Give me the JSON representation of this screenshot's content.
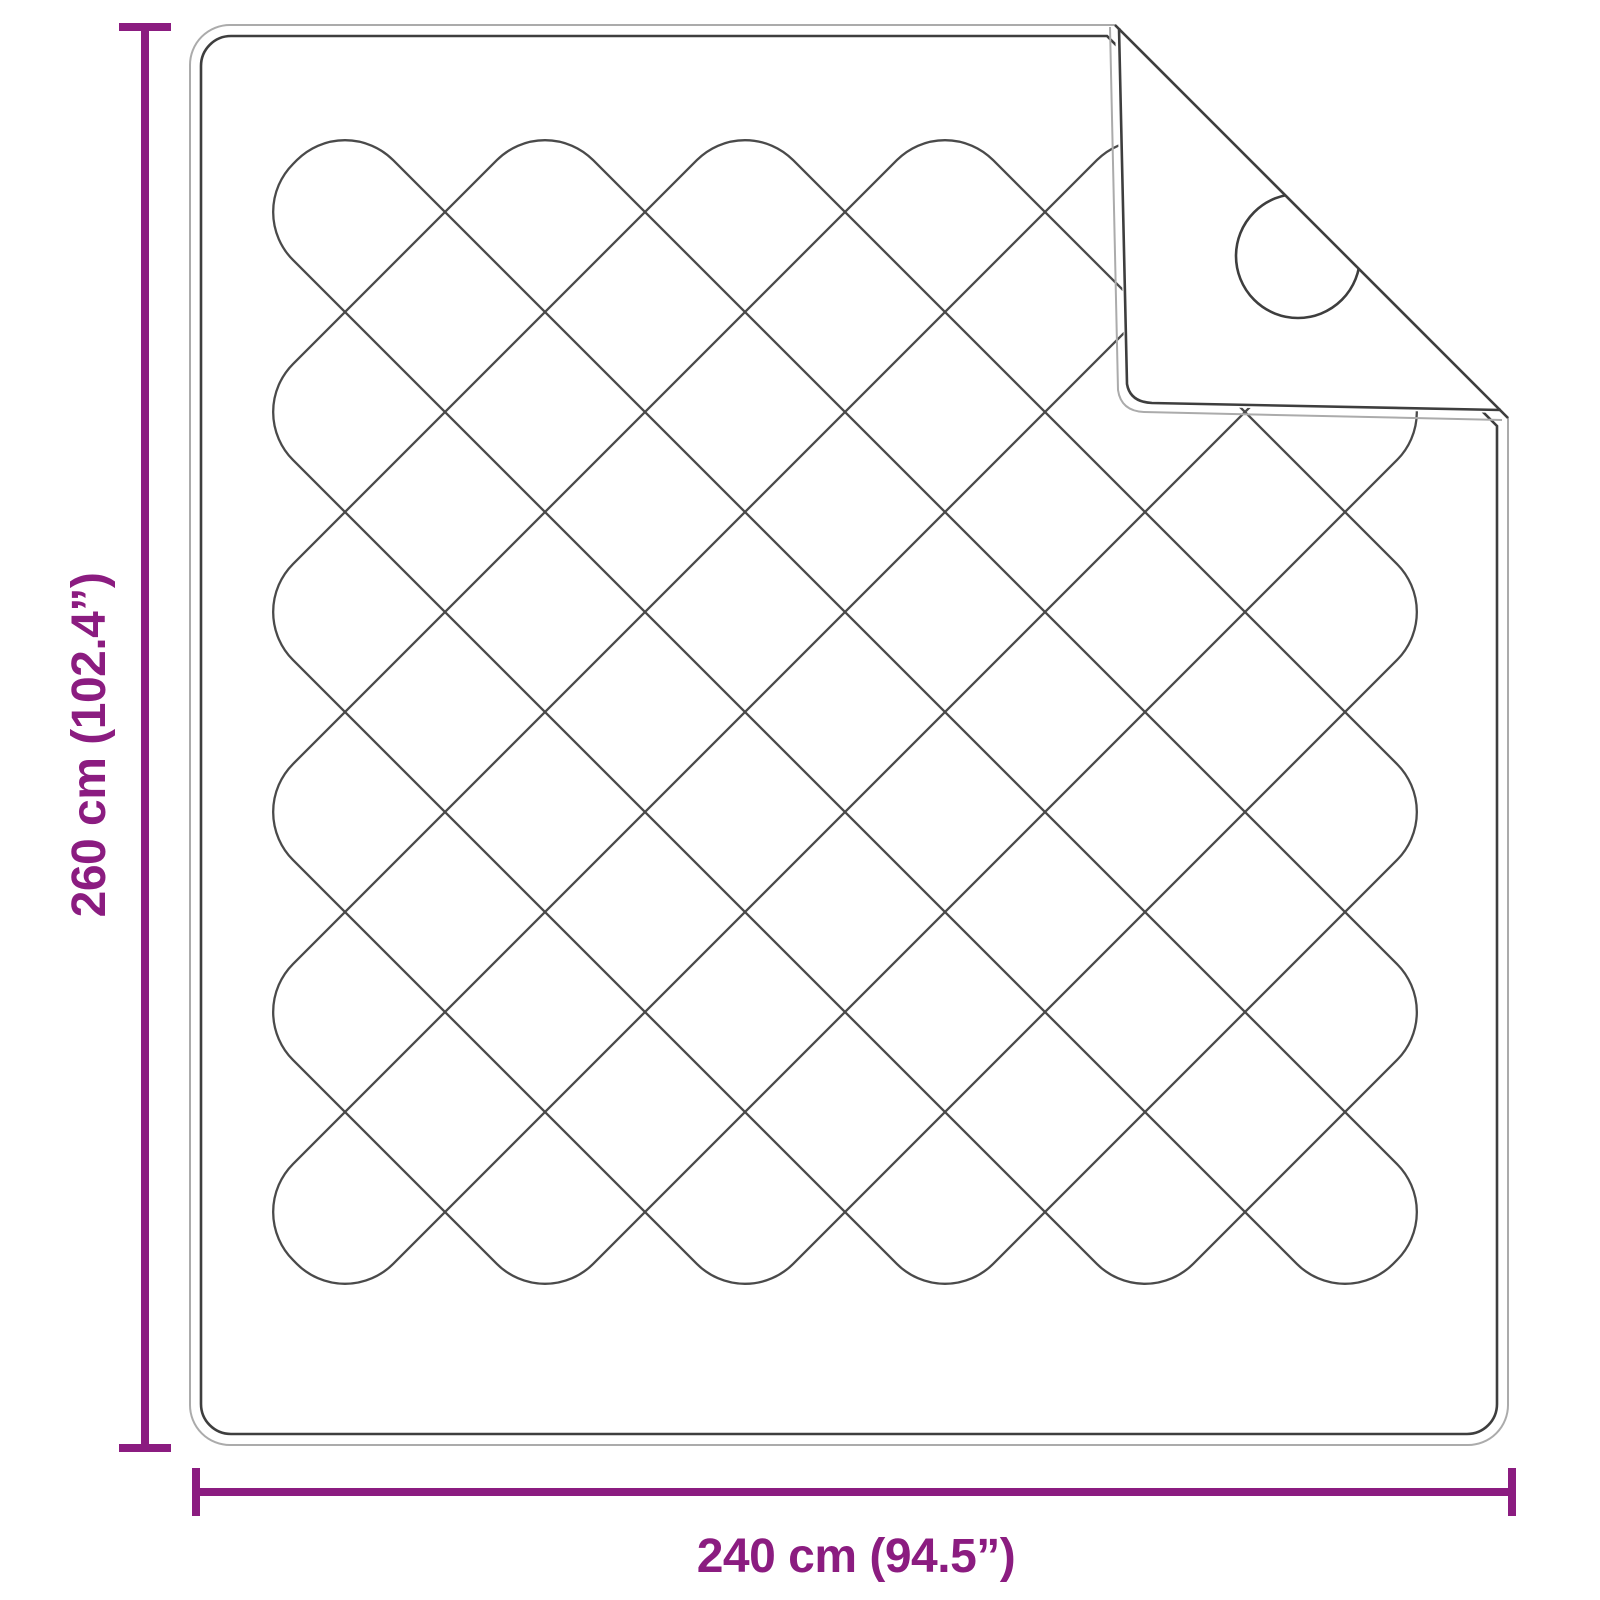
{
  "diagram": {
    "dimensions": {
      "height": {
        "label": "260 cm (102.4”)"
      },
      "width": {
        "label": "240 cm (94.5”)"
      }
    },
    "colors": {
      "accent": "#8B1C80",
      "outline_dark": "#3E3E3E",
      "outline_light": "#ABABAB",
      "stitch": "#4A4A4A",
      "background": "#FFFFFF"
    }
  }
}
